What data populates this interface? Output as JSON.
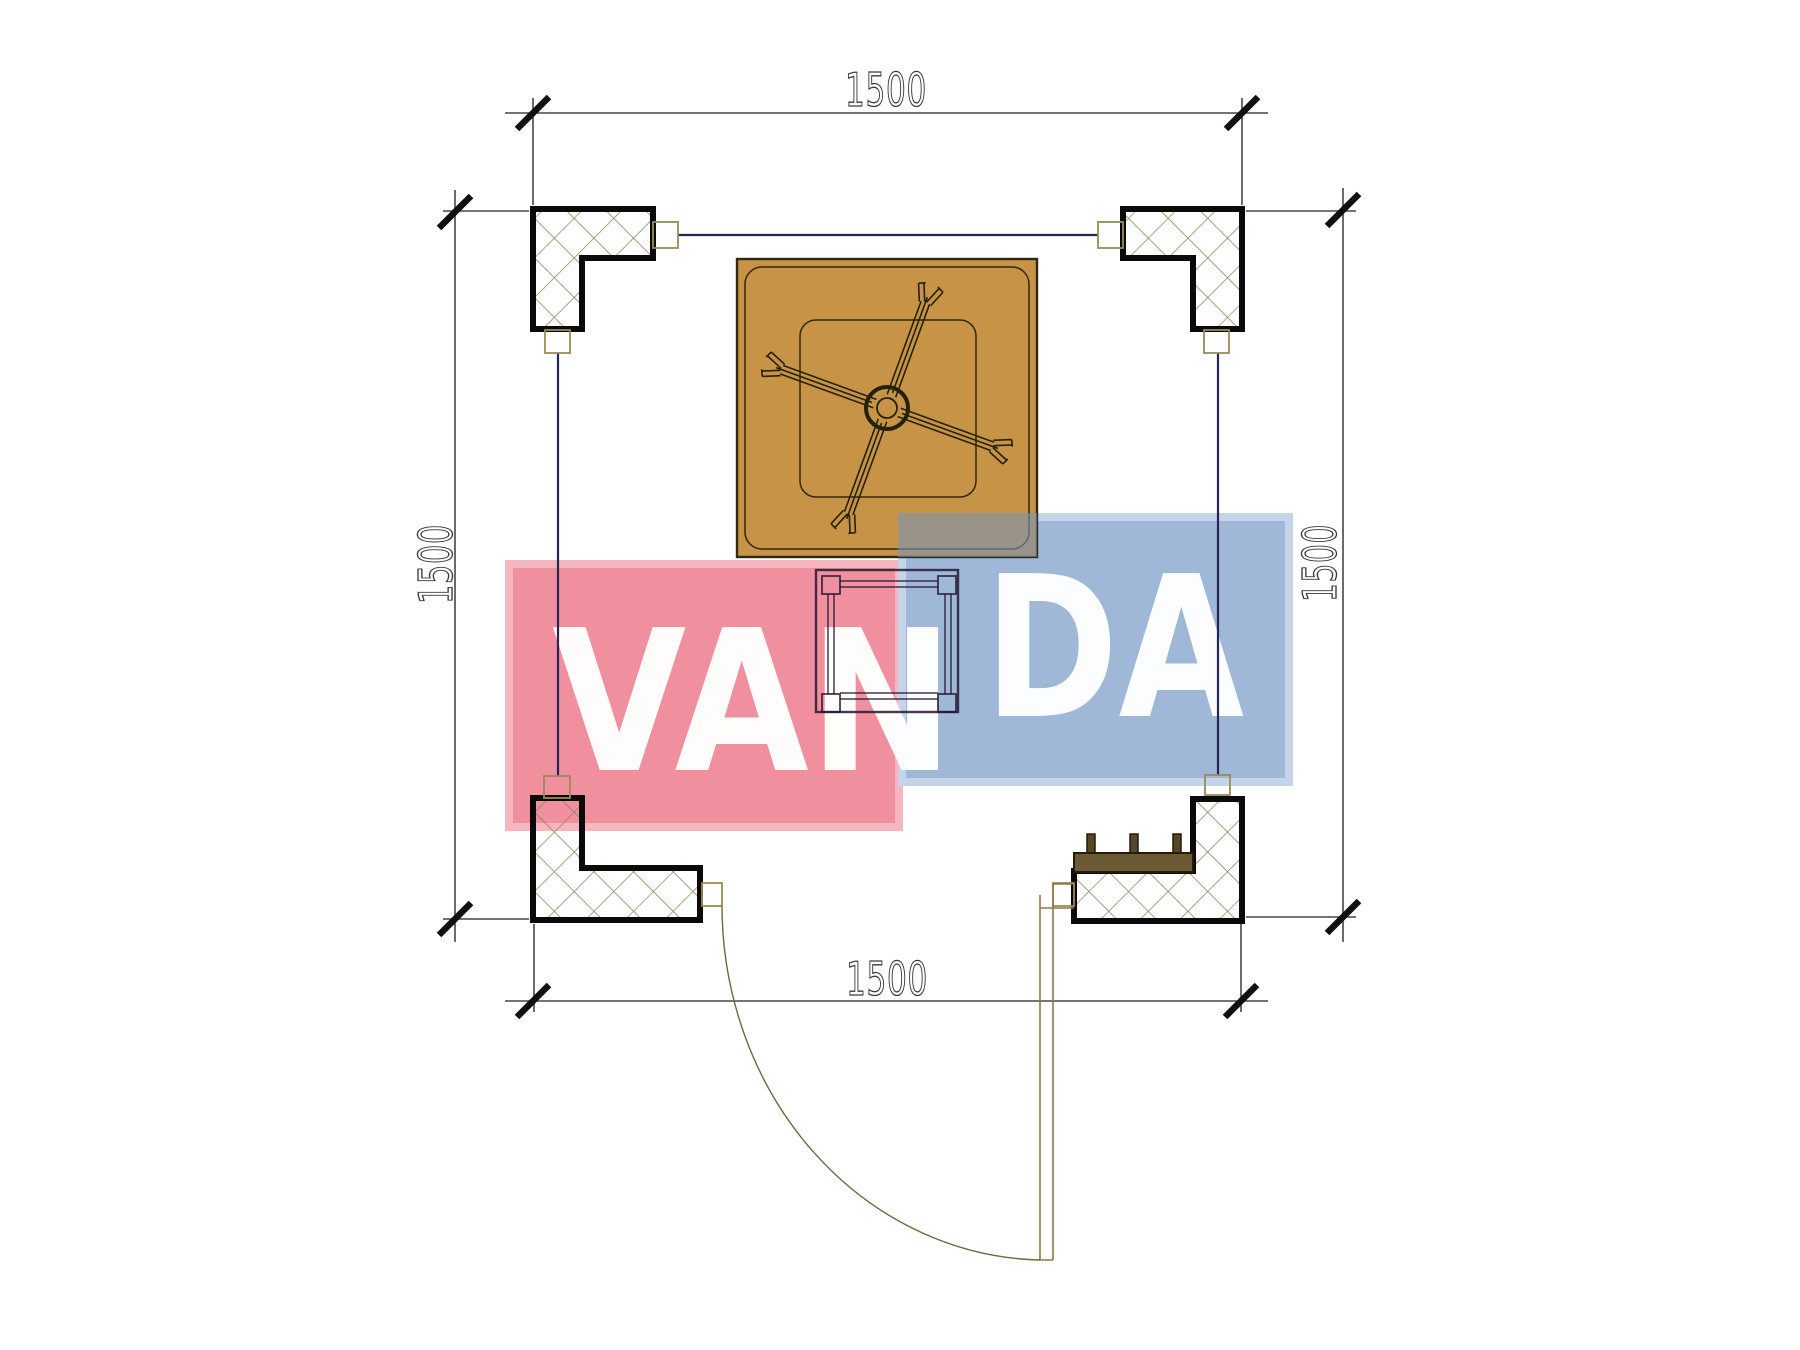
{
  "document": {
    "type": "architectural floor plan",
    "subject": "square gazebo / pavilion plan view with corner columns, canopy fan, table, bench and swing door",
    "units": "mm"
  },
  "dimensions": {
    "top": {
      "label": "1500"
    },
    "bottom": {
      "label": "1500"
    },
    "left": {
      "label": "1500"
    },
    "right": {
      "label": "1500"
    }
  },
  "watermark": {
    "text": "VANDA",
    "left_part": "VAN",
    "right_part": "DA",
    "pink_fill": "#f0909e",
    "pink_edge": "#f5b6bf",
    "blue_fill": "#a0b8d8",
    "blue_edge": "#c5d4e8",
    "letter_color": "#ffffff"
  },
  "plan": {
    "canvas_bg": "#ffffff",
    "column_outline": "#0a0a0a",
    "hatch_color": "#8d7c57",
    "railing_color": "#26265c",
    "dimension_line_color": "#464646",
    "dimension_text_color": "#3a3a3a",
    "tick_color": "#101010",
    "canopy_fill": "#c79447",
    "canopy_outline": "#30280f",
    "bench_fill": "#6b5a33",
    "bench_post_fill": "#554728",
    "door_color": "#8a7a4a",
    "elements": [
      "corner-column-top-left",
      "corner-column-top-right",
      "corner-column-bottom-left",
      "corner-column-bottom-right",
      "perimeter-railings",
      "square-canopy-with-fan",
      "center-table",
      "bench",
      "swing-door"
    ]
  }
}
